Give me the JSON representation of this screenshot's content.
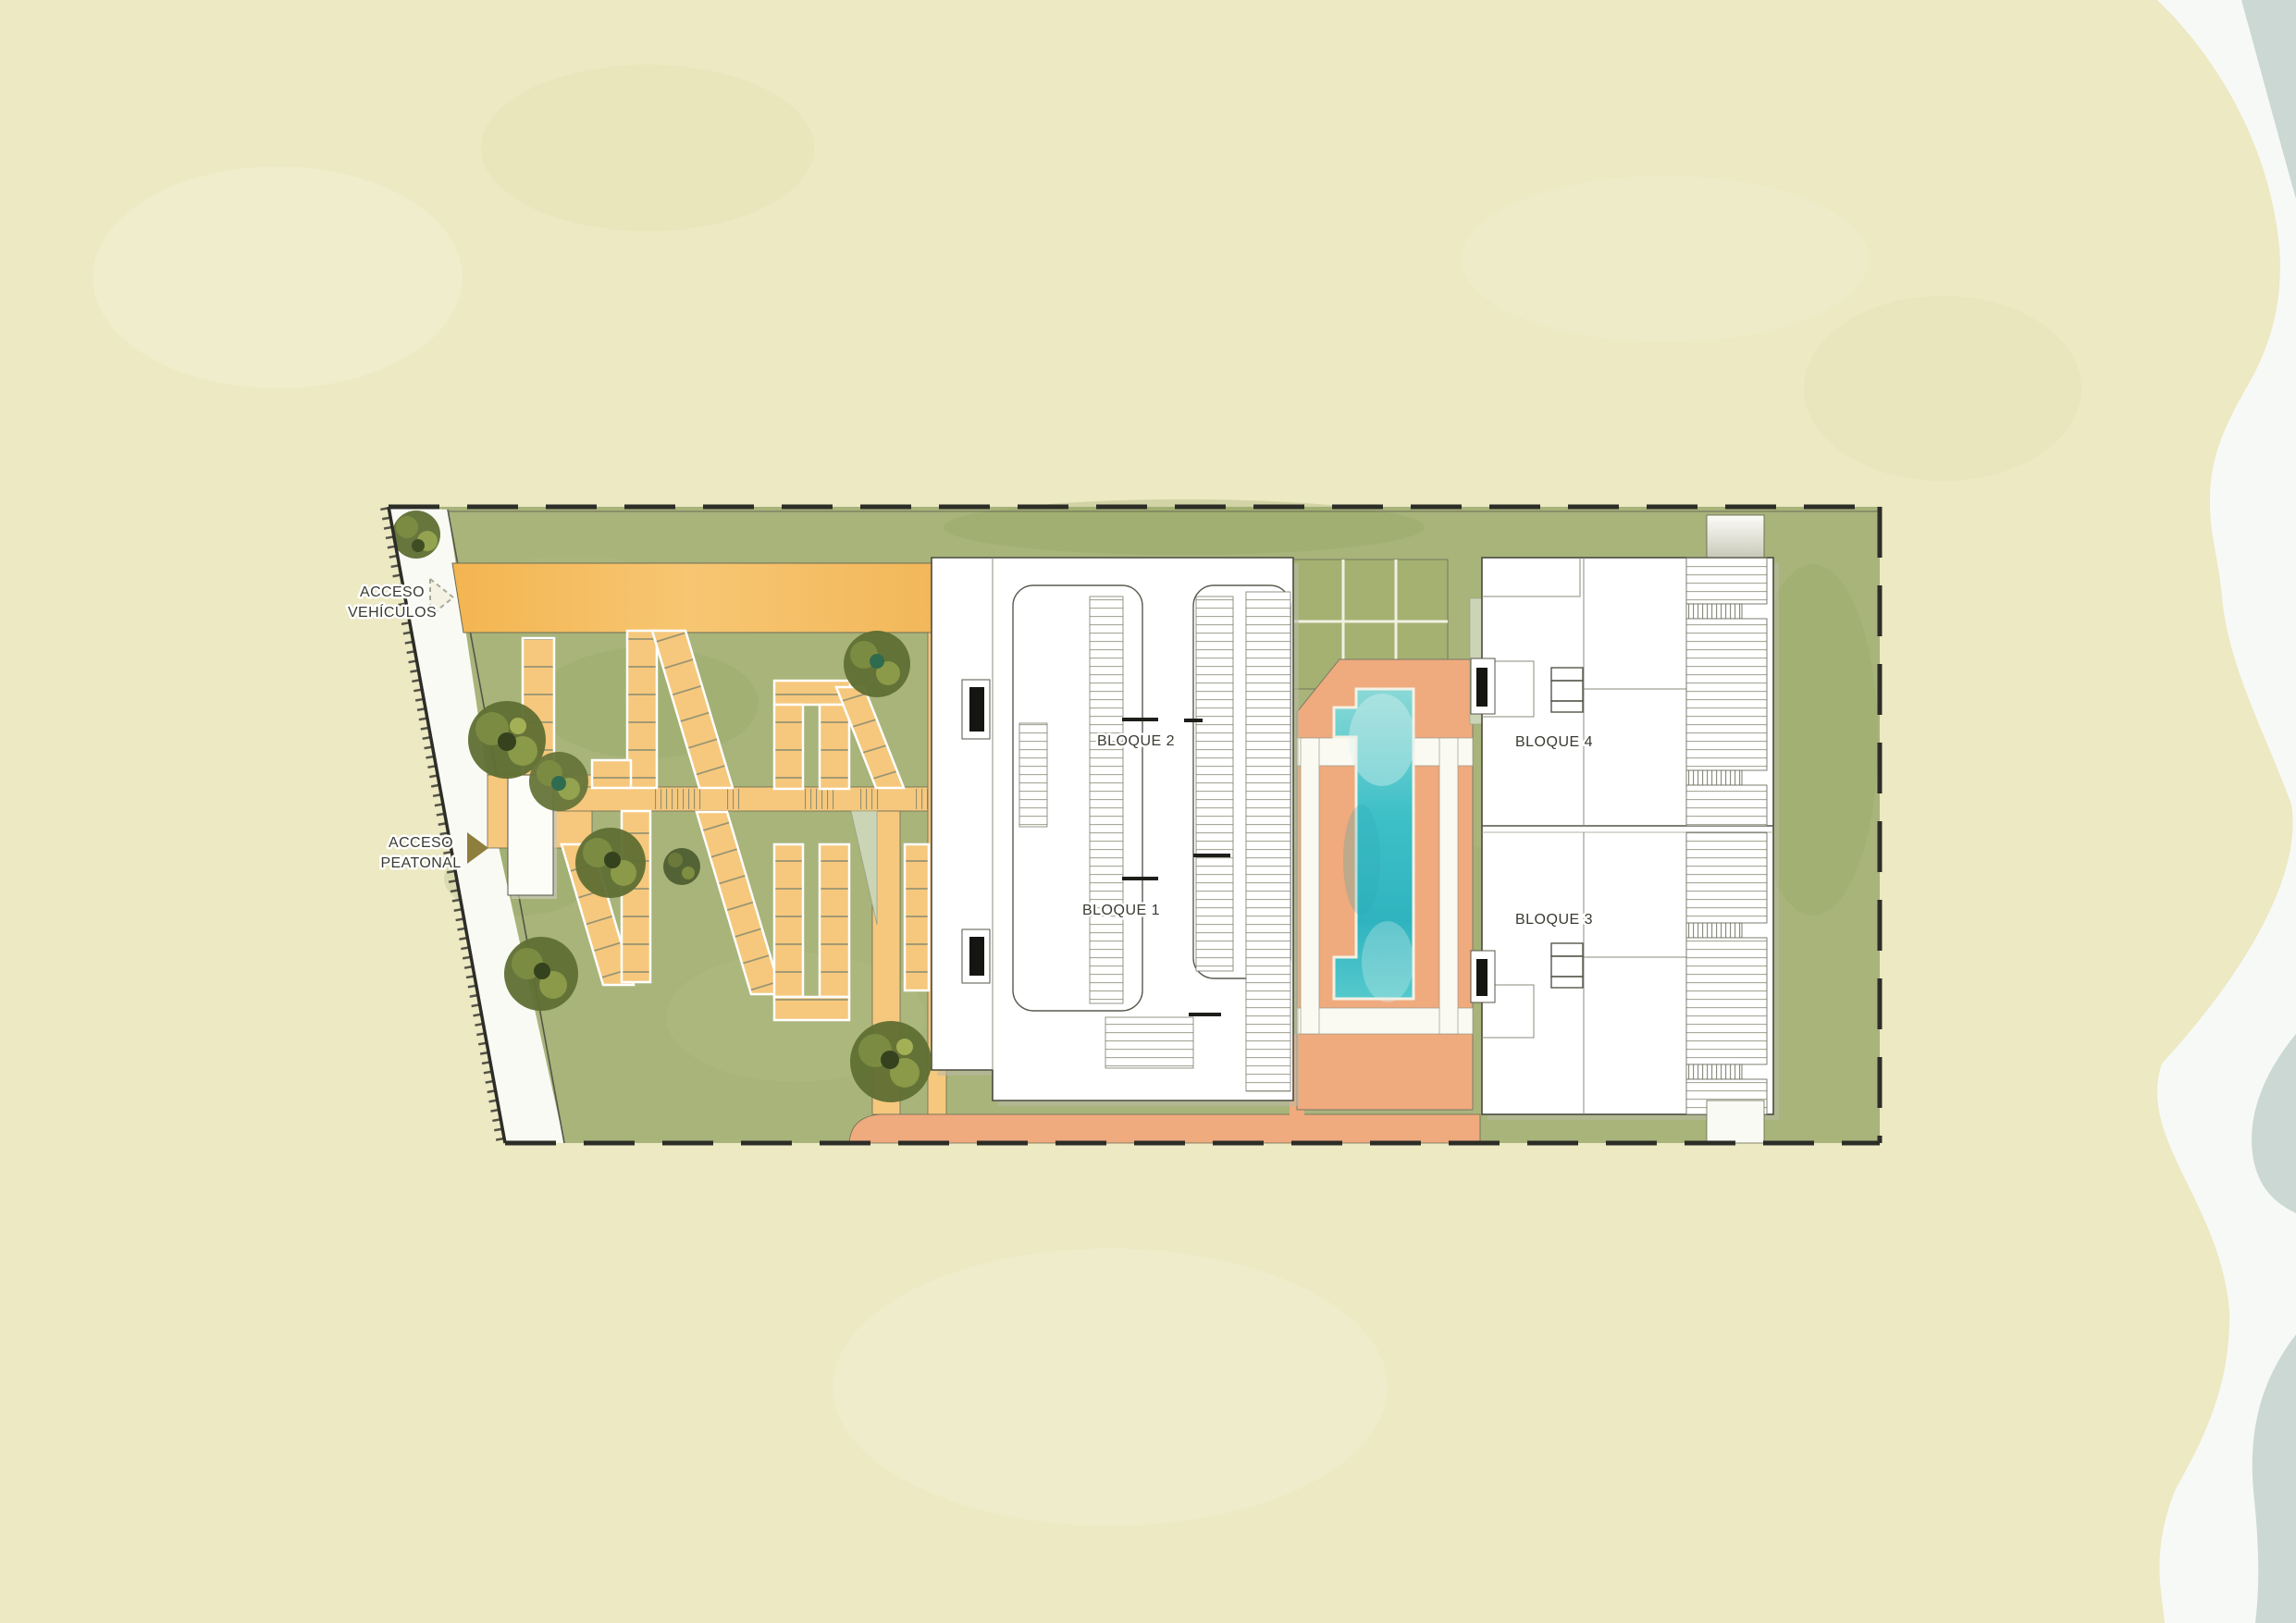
{
  "labels": {
    "access_vehicles_line1": "ACCESO",
    "access_vehicles_line2": "VEHÍCULOS",
    "access_pedestrian_line1": "ACCESO",
    "access_pedestrian_line2": "PEATONAL"
  },
  "blocks": {
    "block1": "BLOQUE 1",
    "block2": "BLOQUE 2",
    "block3": "BLOQUE 3",
    "block4": "BLOQUE 4"
  },
  "colors": {
    "sand": "#ECE9C3",
    "sea_foam": "#F7F9F6",
    "sea_water": "#CBD8D4",
    "grass": "#A8B47A",
    "road_orange": "#F5BC5E",
    "path_yellow": "#F6C87D",
    "deck_salmon": "#EFAA7E",
    "pool_teal": "#3FC0C8",
    "building_white": "#FFFFFF"
  }
}
